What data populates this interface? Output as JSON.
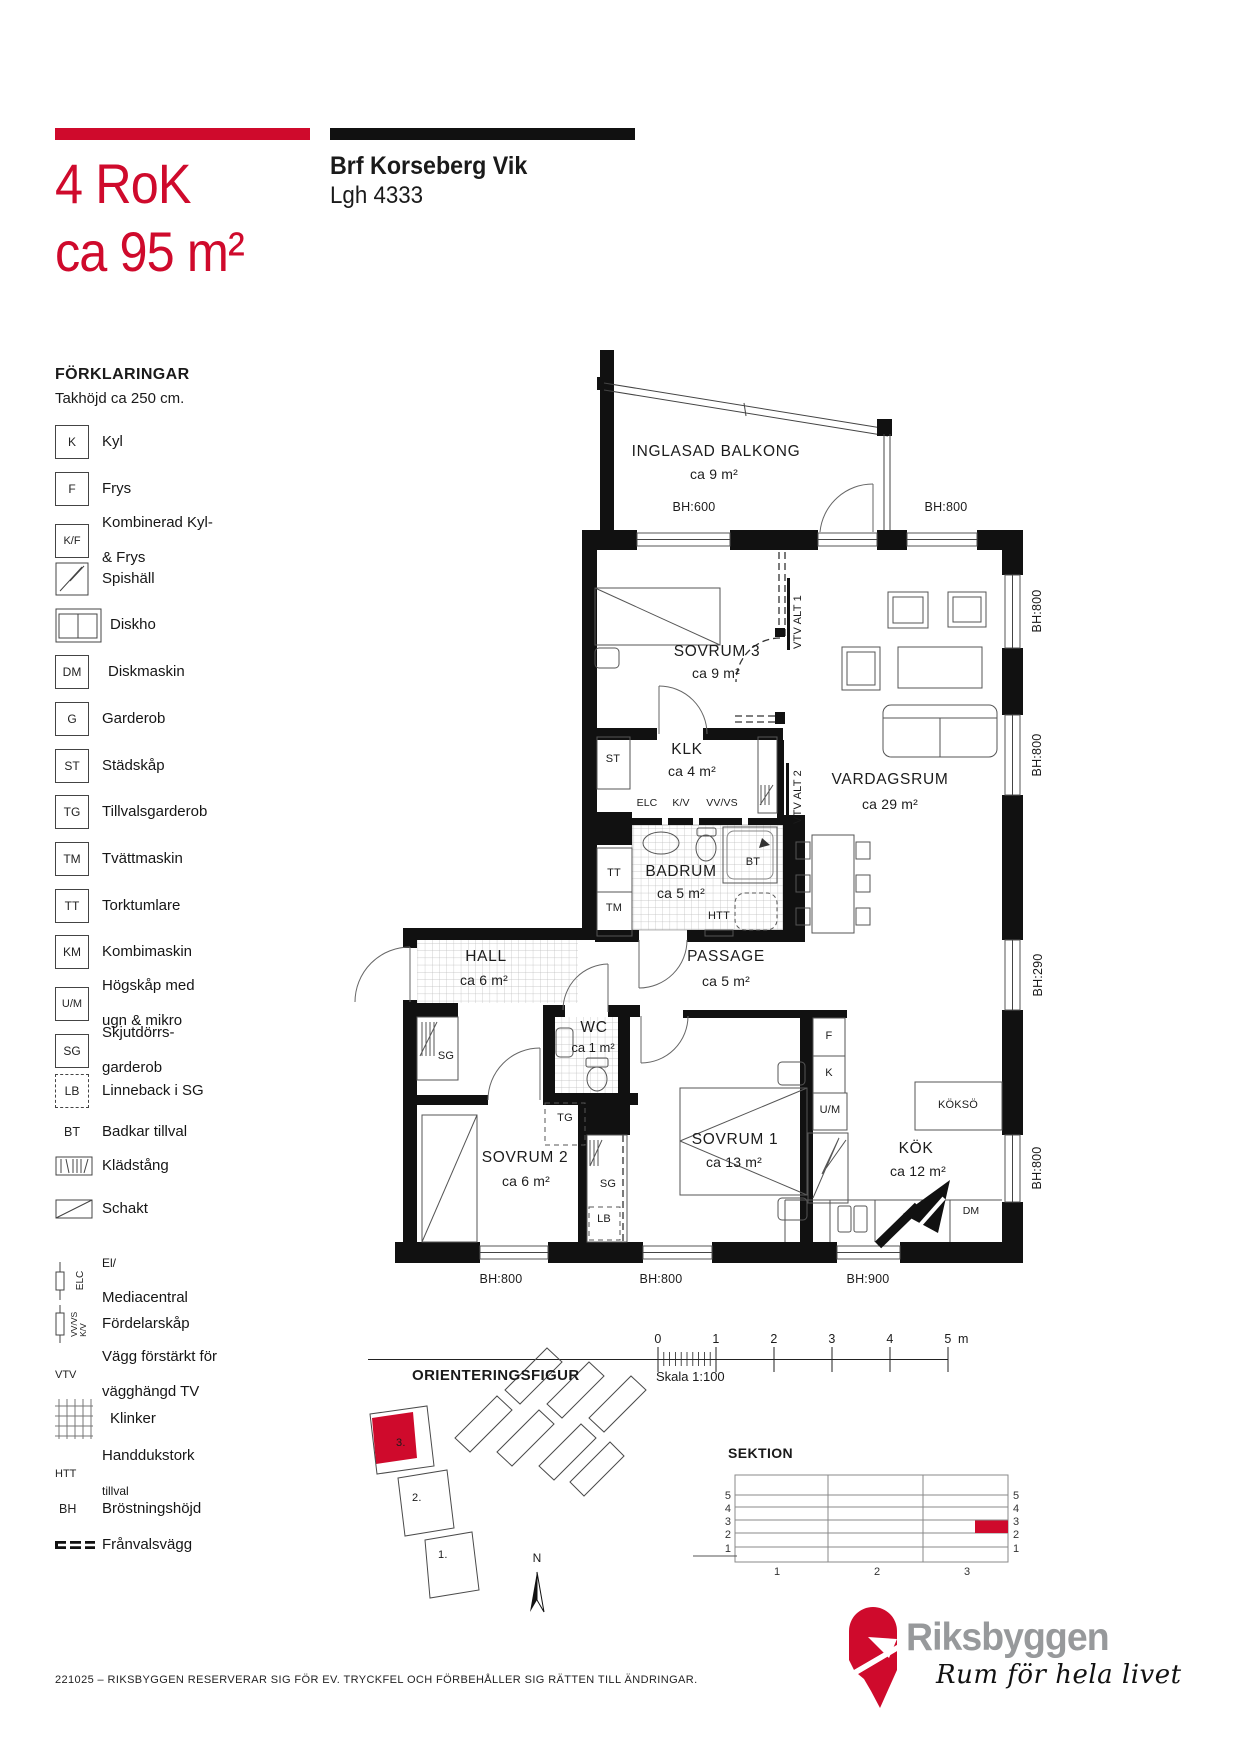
{
  "header": {
    "title_line1": "4 RoK",
    "title_line2": "ca 95 m²",
    "project": "Brf Korseberg Vik",
    "unit": "Lgh 4333"
  },
  "colors": {
    "red": "#cf0a2c",
    "logo_gray": "#97999b"
  },
  "legend": {
    "heading": "FÖRKLARINGAR",
    "subheading": "Takhöjd ca 250 cm.",
    "items": [
      {
        "sym": "K",
        "label": "Kyl"
      },
      {
        "sym": "F",
        "label": "Frys"
      },
      {
        "sym": "K/F",
        "label": "Kombinerad Kyl-",
        "label2": "& Frys"
      },
      {
        "sym": "",
        "label": "Spishäll"
      },
      {
        "sym": "",
        "label": "Diskho"
      },
      {
        "sym": "DM",
        "label": "Diskmaskin"
      },
      {
        "sym": "G",
        "label": "Garderob"
      },
      {
        "sym": "ST",
        "label": "Städskåp"
      },
      {
        "sym": "TG",
        "label": "Tillvalsgarderob"
      },
      {
        "sym": "TM",
        "label": "Tvättmaskin"
      },
      {
        "sym": "TT",
        "label": "Torktumlare"
      },
      {
        "sym": "KM",
        "label": "Kombimaskin"
      },
      {
        "sym": "U/M",
        "label": "Högskåp med",
        "label2": "ugn & mikro"
      },
      {
        "sym": "SG",
        "label": "Skjutdörrs-",
        "label2": "garderob"
      },
      {
        "sym": "LB",
        "label": "Linneback i SG"
      },
      {
        "sym": "BT",
        "label": "Badkar tillval"
      },
      {
        "sym": "",
        "label": "Klädstång"
      },
      {
        "sym": "",
        "label": "Schakt"
      },
      {
        "sym": "ELC",
        "label": "El/",
        "label2": "Mediacentral"
      },
      {
        "sym": "VV/VS",
        "sym2": "K/V",
        "label": "Fördelarskåp"
      },
      {
        "sym": "VTV",
        "label": "Vägg förstärkt för",
        "label2": "vägghängd TV"
      },
      {
        "sym": "",
        "label": "Klinker"
      },
      {
        "sym": "HTT",
        "label": "Handdukstork",
        "label2": "tillval"
      },
      {
        "sym": "BH",
        "label": "Bröstningshöjd"
      },
      {
        "sym": "",
        "label": "Frånvalsvägg"
      }
    ]
  },
  "floorplan": {
    "rooms": {
      "balkong": {
        "name": "INGLASAD BALKONG",
        "area": "ca 9 m²"
      },
      "sovrum3": {
        "name": "SOVRUM 3",
        "area": "ca 9 m²"
      },
      "klk": {
        "name": "KLK",
        "area": "ca 4 m²"
      },
      "vardagsrum": {
        "name": "VARDAGSRUM",
        "area": "ca 29 m²"
      },
      "badrum": {
        "name": "BADRUM",
        "area": "ca 5 m²"
      },
      "hall": {
        "name": "HALL",
        "area": "ca 6 m²"
      },
      "passage": {
        "name": "PASSAGE",
        "area": "ca 5 m²"
      },
      "wc": {
        "name": "WC",
        "area": "ca 1 m²"
      },
      "sovrum2": {
        "name": "SOVRUM 2",
        "area": "ca 6 m²"
      },
      "sovrum1": {
        "name": "SOVRUM 1",
        "area": "ca 13 m²"
      },
      "kok": {
        "name": "KÖK",
        "area": "ca 12 m²"
      }
    },
    "fixtures": {
      "st": "ST",
      "tt": "TT",
      "tm": "TM",
      "elc": "ELC",
      "kv": "K/V",
      "vvvs": "VV/VS",
      "bt": "BT",
      "htt": "HTT",
      "sg_hall": "SG",
      "tg": "TG",
      "sg_sovrum2": "SG",
      "lb": "LB",
      "frys": "F",
      "kyl": "K",
      "um": "U/M",
      "dm": "DM",
      "kokso": "KÖKSÖ",
      "vtv_alt1": "VTV ALT 1",
      "vtv_alt2": "VTV ALT 2"
    },
    "bh": {
      "balkong": "BH:600",
      "top": "BH:800",
      "right1": "BH:800",
      "right2": "BH:800",
      "right3": "BH:290",
      "right4": "BH:800",
      "bottom1": "BH:800",
      "bottom2": "BH:800",
      "bottom3": "BH:900"
    }
  },
  "scalebar": {
    "ticks": [
      "0",
      "1",
      "2",
      "3",
      "4",
      "5"
    ],
    "unit": "m",
    "caption": "Skala 1:100"
  },
  "orientering": {
    "heading": "ORIENTERINGSFIGUR",
    "buildings": [
      "3.",
      "2.",
      "1."
    ],
    "north": "N"
  },
  "sektion": {
    "heading": "SEKTION",
    "floors": [
      "5",
      "4",
      "3",
      "2",
      "1"
    ],
    "columns": [
      "1",
      "2",
      "3"
    ]
  },
  "brand": {
    "name": "Riksbyggen",
    "tagline": "Rum för hela livet"
  },
  "footer": {
    "text": "221025 – RIKSBYGGEN RESERVERAR SIG FÖR EV. TRYCKFEL OCH FÖRBEHÅLLER SIG RÄTTEN TILL ÄNDRINGAR."
  }
}
